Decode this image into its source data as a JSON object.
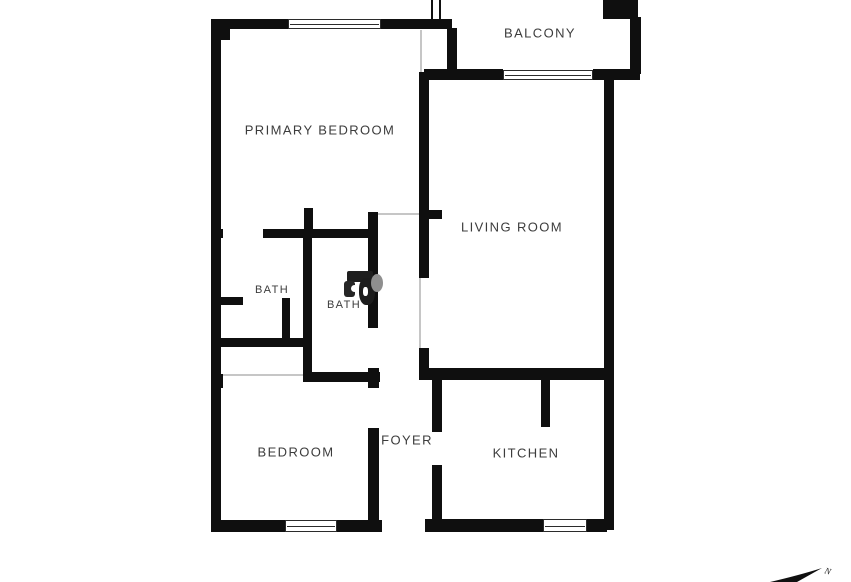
{
  "page": {
    "background": "#ffffff",
    "wall_color": "#0f0f0f",
    "label_color": "#3c3c3c",
    "window_edge_color": "#2b2b2b",
    "open_line_color": "#c6c6c6"
  },
  "floorplan": {
    "rooms": [
      {
        "name": "balcony",
        "label": "BALCONY",
        "cx": 540,
        "cy": 33,
        "size": 13
      },
      {
        "name": "primary-bedroom",
        "label": "PRIMARY BEDROOM",
        "cx": 320,
        "cy": 130,
        "size": 13
      },
      {
        "name": "living-room",
        "label": "LIVING ROOM",
        "cx": 512,
        "cy": 227,
        "size": 13
      },
      {
        "name": "bath-1",
        "label": "BATH",
        "cx": 272,
        "cy": 290,
        "size": 11
      },
      {
        "name": "bath-2",
        "label": "BATH",
        "cx": 344,
        "cy": 305,
        "size": 11
      },
      {
        "name": "bedroom",
        "label": "BEDROOM",
        "cx": 296,
        "cy": 452,
        "size": 13
      },
      {
        "name": "foyer",
        "label": "FOYER",
        "cx": 407,
        "cy": 440,
        "size": 13
      },
      {
        "name": "kitchen",
        "label": "KITCHEN",
        "cx": 526,
        "cy": 453,
        "size": 13
      }
    ],
    "walls": [
      {
        "name": "top-wall-left",
        "x": 211,
        "y": 19,
        "w": 79,
        "h": 10
      },
      {
        "name": "top-wall-right",
        "x": 381,
        "y": 19,
        "w": 71,
        "h": 10
      },
      {
        "name": "top-left-corner-block",
        "x": 211,
        "y": 19,
        "w": 19,
        "h": 21
      },
      {
        "name": "left-exterior-wall",
        "x": 211,
        "y": 19,
        "w": 10,
        "h": 513
      },
      {
        "name": "bottom-wall-bedroom-a",
        "x": 211,
        "y": 520,
        "w": 74,
        "h": 12
      },
      {
        "name": "bottom-wall-bedroom-b",
        "x": 337,
        "y": 520,
        "w": 45,
        "h": 12
      },
      {
        "name": "bedroom-right-wall-stub",
        "x": 368,
        "y": 368,
        "w": 11,
        "h": 20
      },
      {
        "name": "bedroom-right-wall",
        "x": 368,
        "y": 428,
        "w": 11,
        "h": 104
      },
      {
        "name": "kitchen-bottom-wall-a",
        "x": 425,
        "y": 519,
        "w": 118,
        "h": 13
      },
      {
        "name": "kitchen-bottom-wall-b",
        "x": 587,
        "y": 519,
        "w": 20,
        "h": 13
      },
      {
        "name": "right-exterior-wall",
        "x": 604,
        "y": 78,
        "w": 10,
        "h": 452
      },
      {
        "name": "balcony-bottom-wall-left",
        "x": 424,
        "y": 69,
        "w": 79,
        "h": 11
      },
      {
        "name": "balcony-bottom-wall-right",
        "x": 593,
        "y": 69,
        "w": 47,
        "h": 11
      },
      {
        "name": "balcony-left-wall",
        "x": 447,
        "y": 28,
        "w": 10,
        "h": 47
      },
      {
        "name": "balcony-right-wall",
        "x": 630,
        "y": 17,
        "w": 11,
        "h": 57
      },
      {
        "name": "top-right-block",
        "x": 603,
        "y": 0,
        "w": 35,
        "h": 19
      },
      {
        "name": "primary-bedroom-right-wall",
        "x": 419,
        "y": 72,
        "w": 10,
        "h": 140
      },
      {
        "name": "living-room-left-stub",
        "x": 419,
        "y": 210,
        "w": 23,
        "h": 9
      },
      {
        "name": "living-room-left-wall-mid",
        "x": 419,
        "y": 219,
        "w": 10,
        "h": 59
      },
      {
        "name": "living-room-left-wall-low",
        "x": 419,
        "y": 348,
        "w": 10,
        "h": 32
      },
      {
        "name": "bath-top-stub-left",
        "x": 216,
        "y": 229,
        "w": 7,
        "h": 9
      },
      {
        "name": "bath-top-wall",
        "x": 263,
        "y": 229,
        "w": 109,
        "h": 9
      },
      {
        "name": "bath-divider-top-stub",
        "x": 304,
        "y": 208,
        "w": 9,
        "h": 22
      },
      {
        "name": "bath-divider-wall",
        "x": 303,
        "y": 229,
        "w": 9,
        "h": 153
      },
      {
        "name": "bath1-nook-stub-h",
        "x": 220,
        "y": 297,
        "w": 23,
        "h": 8
      },
      {
        "name": "bath1-nook-stub-v",
        "x": 282,
        "y": 298,
        "w": 8,
        "h": 42
      },
      {
        "name": "bath1-bottom-wall",
        "x": 216,
        "y": 338,
        "w": 96,
        "h": 9
      },
      {
        "name": "bedroom-top-wall",
        "x": 303,
        "y": 372,
        "w": 77,
        "h": 10
      },
      {
        "name": "hall-left-wall",
        "x": 368,
        "y": 212,
        "w": 10,
        "h": 116
      },
      {
        "name": "kitchen-top-wall",
        "x": 429,
        "y": 368,
        "w": 178,
        "h": 12
      },
      {
        "name": "kitchen-left-wall-top",
        "x": 432,
        "y": 380,
        "w": 10,
        "h": 52
      },
      {
        "name": "kitchen-left-wall-bottom",
        "x": 432,
        "y": 465,
        "w": 10,
        "h": 66
      },
      {
        "name": "kitchen-interior-stub",
        "x": 541,
        "y": 380,
        "w": 9,
        "h": 47
      },
      {
        "name": "left-wall-notch",
        "x": 211,
        "y": 374,
        "w": 12,
        "h": 14
      }
    ],
    "windows": [
      {
        "name": "primary-bedroom-top-window",
        "x": 288,
        "y": 19,
        "w": 93,
        "h": 10
      },
      {
        "name": "balcony-railing",
        "x": 503,
        "y": 70,
        "w": 90,
        "h": 10
      },
      {
        "name": "bedroom-bottom-window",
        "x": 285,
        "y": 520,
        "w": 52,
        "h": 12
      },
      {
        "name": "kitchen-bottom-window",
        "x": 543,
        "y": 519,
        "w": 44,
        "h": 13
      }
    ],
    "open_lines": [
      {
        "name": "closet-open-line",
        "x": 223,
        "y": 374,
        "w": 80,
        "h": 2
      },
      {
        "name": "hallway-open-line",
        "x": 378,
        "y": 213,
        "w": 41,
        "h": 2
      },
      {
        "name": "living-room-arch-line",
        "x": 419,
        "y": 278,
        "w": 2,
        "h": 70
      },
      {
        "name": "balcony-door-line",
        "x": 420,
        "y": 30,
        "w": 2,
        "h": 42
      }
    ],
    "wall_stub_outline": {
      "name": "top-open-wall-stub",
      "x": 431,
      "y": 0,
      "w": 10,
      "h": 19
    },
    "watermark": {
      "fragments": [
        {
          "name": "watermark-frag-1",
          "x": 347,
          "y": 271,
          "w": 26,
          "h": 11,
          "color": "#1e1e1e",
          "radius": "2px"
        },
        {
          "name": "watermark-frag-2",
          "x": 344,
          "y": 281,
          "w": 11,
          "h": 16,
          "color": "#262626",
          "radius": "3px"
        },
        {
          "name": "watermark-frag-3",
          "x": 359,
          "y": 278,
          "w": 16,
          "h": 27,
          "color": "#1c1c1c",
          "radius": "40% 40% 45% 45%"
        },
        {
          "name": "watermark-frag-4",
          "x": 371,
          "y": 274,
          "w": 12,
          "h": 18,
          "color": "#8f8f8f",
          "radius": "50%"
        },
        {
          "name": "watermark-hole-1",
          "x": 351,
          "y": 285,
          "w": 7,
          "h": 7,
          "color": "#ffffff",
          "radius": "50%"
        },
        {
          "name": "watermark-hole-2",
          "x": 363,
          "y": 287,
          "w": 5,
          "h": 9,
          "color": "#ffffff",
          "radius": "40%"
        }
      ]
    },
    "compass": {
      "label": "N"
    }
  }
}
